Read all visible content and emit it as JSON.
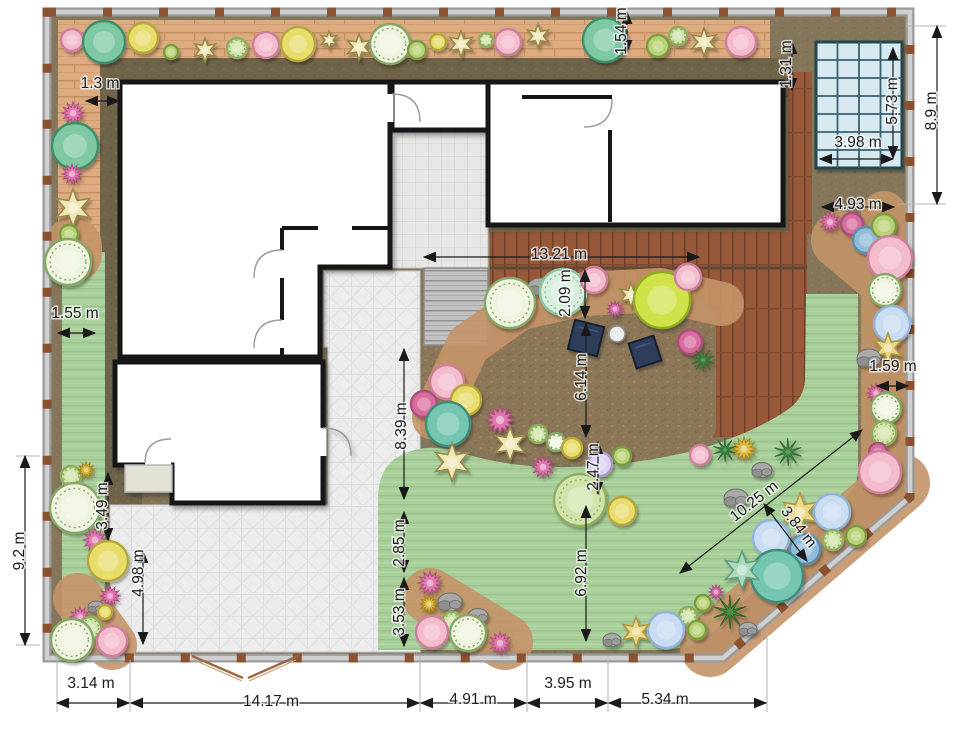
{
  "title": "garden-landscape-plan",
  "unit": "m",
  "dimensions": [
    {
      "label": "1.3 m",
      "x": 100,
      "y": 88,
      "rot": 0,
      "line": [
        86,
        101,
        119,
        101
      ]
    },
    {
      "label": "1.54 m",
      "x": 626,
      "y": 31,
      "rot": -90,
      "line": [
        627,
        12,
        627,
        52
      ]
    },
    {
      "label": "1.31 m",
      "x": 791,
      "y": 64,
      "rot": -90,
      "line": [
        792,
        42,
        792,
        90
      ]
    },
    {
      "label": "5.73 m",
      "x": 897,
      "y": 101,
      "rot": -90,
      "line": [
        893,
        48,
        893,
        158
      ]
    },
    {
      "label": "3.98 m",
      "x": 858,
      "y": 147,
      "rot": 0,
      "line": [
        820,
        159,
        893,
        159
      ]
    },
    {
      "label": "8.9 m",
      "x": 936,
      "y": 111,
      "rot": -90,
      "line": [
        937,
        26,
        937,
        204
      ]
    },
    {
      "label": "4.93 m",
      "x": 858,
      "y": 209,
      "rot": 0,
      "line": [
        822,
        207,
        894,
        207
      ]
    },
    {
      "label": "13.21 m",
      "x": 559,
      "y": 259,
      "rot": 0,
      "line": [
        424,
        257,
        699,
        257
      ]
    },
    {
      "label": "2.09 m",
      "x": 570,
      "y": 293,
      "rot": -90,
      "line": [
        585,
        270,
        585,
        318
      ]
    },
    {
      "label": "6.14 m",
      "x": 586,
      "y": 377,
      "rot": -90,
      "line": [
        586,
        324,
        586,
        437
      ]
    },
    {
      "label": "1.55 m",
      "x": 75,
      "y": 318,
      "rot": 0,
      "line": [
        58,
        333,
        95,
        333
      ]
    },
    {
      "label": "1.59 m",
      "x": 893,
      "y": 371,
      "rot": 0,
      "line": [
        877,
        386,
        908,
        386
      ]
    },
    {
      "label": "8.39 m",
      "x": 406,
      "y": 426,
      "rot": -90,
      "line": [
        404,
        349,
        404,
        499
      ]
    },
    {
      "label": "2.47 m",
      "x": 598,
      "y": 467,
      "rot": -90,
      "line": [
        598,
        442,
        598,
        494
      ]
    },
    {
      "label": "6.92 m",
      "x": 586,
      "y": 573,
      "rot": -90,
      "line": [
        586,
        506,
        586,
        641
      ]
    },
    {
      "label": "10.25 m",
      "x": 757,
      "y": 505,
      "rot": -38,
      "line": [
        680,
        573,
        862,
        430
      ]
    },
    {
      "label": "3.84 m",
      "x": 795,
      "y": 530,
      "rot": 52,
      "line": [
        764,
        504,
        807,
        561
      ]
    },
    {
      "label": "3.49 m",
      "x": 107,
      "y": 506,
      "rot": -90,
      "line": [
        108,
        473,
        108,
        540
      ]
    },
    {
      "label": "4.98 m",
      "x": 143,
      "y": 573,
      "rot": -90,
      "line": [
        143,
        551,
        143,
        644
      ]
    },
    {
      "label": "9.2 m",
      "x": 24,
      "y": 551,
      "rot": -90,
      "line": [
        25,
        456,
        25,
        645
      ]
    },
    {
      "label": "2.85 m",
      "x": 404,
      "y": 543,
      "rot": -90,
      "line": [
        404,
        512,
        404,
        572
      ]
    },
    {
      "label": "3.53 m",
      "x": 404,
      "y": 612,
      "rot": -90,
      "line": [
        404,
        578,
        404,
        646
      ]
    },
    {
      "label": "3.14 m",
      "x": 91,
      "y": 688,
      "rot": 0,
      "line": [
        57,
        703,
        129,
        703
      ]
    },
    {
      "label": "14.17 m",
      "x": 271,
      "y": 706,
      "rot": 0,
      "line": [
        131,
        703,
        419,
        703
      ]
    },
    {
      "label": "4.91 m",
      "x": 473,
      "y": 704,
      "rot": 0,
      "line": [
        421,
        703,
        526,
        703
      ]
    },
    {
      "label": "3.95 m",
      "x": 568,
      "y": 688,
      "rot": 0,
      "line": [
        528,
        703,
        607,
        703
      ]
    },
    {
      "label": "5.34 m",
      "x": 665,
      "y": 704,
      "rot": 0,
      "line": [
        609,
        703,
        766,
        703
      ]
    }
  ],
  "pool": {
    "x": 816,
    "y": 42,
    "w": 86,
    "h": 126,
    "cols": 4,
    "rows": 7,
    "fill": "#d7e8ee",
    "grid": "#3a616f",
    "border": "#24454f"
  },
  "furniture": {
    "loungers": [
      {
        "x": 586,
        "y": 338,
        "s": 30,
        "rot": 14
      },
      {
        "x": 645,
        "y": 352,
        "s": 26,
        "rot": -18
      }
    ],
    "lounger_fill": "#2d3c5a",
    "lounger_edge": "#17202e",
    "table": {
      "x": 617,
      "y": 334,
      "r": 8,
      "fill": "#ececec",
      "edge": "#8f8f8f"
    }
  },
  "palette": {
    "pink": {
      "f": "#f3bccd",
      "e": "#cd7f9c",
      "t": "c"
    },
    "magenta": {
      "f": "#e077ae",
      "e": "#b34d86",
      "t": "a"
    },
    "magenta2": {
      "f": "#d76d9f",
      "e": "#a94f7c",
      "t": "c"
    },
    "gold": {
      "f": "#e8dc6b",
      "e": "#b5a73e",
      "t": "c"
    },
    "goldspiky": {
      "f": "#d9b83a",
      "e": "#a8861f",
      "t": "a"
    },
    "star": {
      "f": "#efe7b8",
      "e": "#97894a",
      "t": "s"
    },
    "starGold": {
      "f": "#ead98a",
      "e": "#b09a40",
      "t": "s"
    },
    "starTeal": {
      "f": "#abd9bd",
      "e": "#5fa183",
      "t": "s"
    },
    "teal": {
      "f": "#7fc8a4",
      "e": "#418f6a",
      "t": "c"
    },
    "teal2": {
      "f": "#74c6b0",
      "e": "#3d8f7c",
      "t": "c"
    },
    "mint": {
      "f": "#d9efdd",
      "e": "#8cc4a0",
      "t": "c"
    },
    "dotted": {
      "f": "#eef4e0",
      "e": "#85a765",
      "t": "c"
    },
    "sage": {
      "f": "#b8d276",
      "e": "#7d9c42",
      "t": "c"
    },
    "sage2": {
      "f": "#cfe3ab",
      "e": "#8fae5e",
      "t": "c"
    },
    "lime": {
      "f": "#cfe24a",
      "e": "#8fae20",
      "t": "c"
    },
    "blue": {
      "f": "#c9dcf2",
      "e": "#93b3d9",
      "t": "c"
    },
    "blue2": {
      "f": "#8fbcd8",
      "e": "#5c8fae",
      "t": "c"
    },
    "lilac": {
      "f": "#ddd2f0",
      "e": "#a899cc",
      "t": "c"
    },
    "palm": {
      "f": "#58a358",
      "e": "#2f6f32",
      "t": "g"
    },
    "grass": {
      "f": "#4e8f46",
      "e": "#2e6327",
      "t": "g"
    },
    "rock": {
      "f": "#a9a9a9",
      "e": "#787878",
      "t": "r"
    }
  },
  "plants": [
    [
      72,
      40,
      11,
      "pink"
    ],
    [
      104,
      42,
      21,
      "teal"
    ],
    [
      143,
      38,
      15,
      "gold"
    ],
    [
      171,
      52,
      7,
      "sage"
    ],
    [
      205,
      50,
      12,
      "star"
    ],
    [
      237,
      48,
      10,
      "sage2"
    ],
    [
      266,
      45,
      13,
      "pink"
    ],
    [
      298,
      44,
      17,
      "gold"
    ],
    [
      329,
      40,
      9,
      "star"
    ],
    [
      359,
      47,
      13,
      "star"
    ],
    [
      390,
      44,
      20,
      "dotted"
    ],
    [
      417,
      50,
      9,
      "sage"
    ],
    [
      438,
      42,
      8,
      "gold"
    ],
    [
      461,
      44,
      13,
      "star"
    ],
    [
      486,
      40,
      7,
      "sage2"
    ],
    [
      508,
      42,
      13,
      "pink"
    ],
    [
      538,
      36,
      12,
      "star"
    ],
    [
      605,
      40,
      22,
      "teal"
    ],
    [
      658,
      46,
      11,
      "sage"
    ],
    [
      678,
      36,
      9,
      "sage2"
    ],
    [
      704,
      42,
      14,
      "star"
    ],
    [
      741,
      42,
      15,
      "pink"
    ],
    [
      73,
      113,
      11,
      "magenta"
    ],
    [
      75,
      146,
      23,
      "teal"
    ],
    [
      72,
      174,
      10,
      "magenta"
    ],
    [
      73,
      208,
      19,
      "star"
    ],
    [
      69,
      234,
      9,
      "sage"
    ],
    [
      68,
      262,
      23,
      "dotted"
    ],
    [
      71,
      476,
      10,
      "sage2"
    ],
    [
      86,
      470,
      8,
      "goldspiky"
    ],
    [
      75,
      508,
      25,
      "dotted"
    ],
    [
      95,
      540,
      12,
      "magenta"
    ],
    [
      108,
      561,
      20,
      "gold"
    ],
    [
      110,
      596,
      10,
      "magenta"
    ],
    [
      96,
      607,
      8,
      "rock"
    ],
    [
      80,
      617,
      10,
      "magenta"
    ],
    [
      90,
      628,
      11,
      "sage2"
    ],
    [
      105,
      612,
      7,
      "gold"
    ],
    [
      72,
      640,
      21,
      "dotted"
    ],
    [
      112,
      641,
      15,
      "pink"
    ],
    [
      447,
      382,
      17,
      "pink"
    ],
    [
      424,
      404,
      13,
      "magenta2"
    ],
    [
      466,
      400,
      15,
      "gold"
    ],
    [
      448,
      424,
      22,
      "teal2"
    ],
    [
      500,
      420,
      14,
      "magenta"
    ],
    [
      452,
      462,
      19,
      "star"
    ],
    [
      510,
      444,
      17,
      "star"
    ],
    [
      538,
      434,
      9,
      "sage2"
    ],
    [
      556,
      442,
      9,
      "dotted"
    ],
    [
      572,
      448,
      10,
      "gold"
    ],
    [
      543,
      467,
      11,
      "magenta"
    ],
    [
      600,
      464,
      12,
      "lilac"
    ],
    [
      622,
      456,
      9,
      "sage"
    ],
    [
      580,
      500,
      26,
      "sage2"
    ],
    [
      622,
      511,
      14,
      "gold"
    ],
    [
      540,
      287,
      12,
      "rock"
    ],
    [
      510,
      303,
      25,
      "dotted"
    ],
    [
      563,
      292,
      23,
      "mint"
    ],
    [
      594,
      280,
      13,
      "pink"
    ],
    [
      615,
      309,
      8,
      "magenta"
    ],
    [
      631,
      295,
      12,
      "star"
    ],
    [
      662,
      300,
      28,
      "lime"
    ],
    [
      688,
      277,
      13,
      "pink"
    ],
    [
      690,
      342,
      12,
      "magenta2"
    ],
    [
      703,
      360,
      12,
      "palm"
    ],
    [
      830,
      222,
      10,
      "magenta"
    ],
    [
      852,
      224,
      11,
      "magenta2"
    ],
    [
      866,
      240,
      13,
      "blue2"
    ],
    [
      884,
      226,
      12,
      "sage"
    ],
    [
      890,
      258,
      22,
      "pink"
    ],
    [
      885,
      290,
      16,
      "dotted"
    ],
    [
      892,
      324,
      18,
      "blue"
    ],
    [
      888,
      348,
      15,
      "starGold"
    ],
    [
      869,
      358,
      12,
      "rock"
    ],
    [
      876,
      393,
      9,
      "magenta"
    ],
    [
      886,
      408,
      15,
      "dotted"
    ],
    [
      884,
      433,
      12,
      "sage2"
    ],
    [
      878,
      452,
      9,
      "magenta2"
    ],
    [
      880,
      472,
      21,
      "pink"
    ],
    [
      700,
      455,
      10,
      "pink"
    ],
    [
      725,
      450,
      12,
      "palm"
    ],
    [
      744,
      449,
      12,
      "goldspiky"
    ],
    [
      762,
      470,
      10,
      "rock"
    ],
    [
      788,
      452,
      14,
      "palm"
    ],
    [
      736,
      498,
      12,
      "rock"
    ],
    [
      800,
      512,
      19,
      "starGold"
    ],
    [
      832,
      512,
      18,
      "blue"
    ],
    [
      856,
      536,
      10,
      "sage"
    ],
    [
      833,
      540,
      10,
      "sage2"
    ],
    [
      805,
      549,
      15,
      "blue2"
    ],
    [
      771,
      538,
      18,
      "blue"
    ],
    [
      777,
      576,
      26,
      "teal2"
    ],
    [
      742,
      570,
      19,
      "starTeal"
    ],
    [
      716,
      592,
      7,
      "magenta"
    ],
    [
      730,
      612,
      17,
      "grass"
    ],
    [
      703,
      603,
      8,
      "sage"
    ],
    [
      688,
      616,
      9,
      "sage2"
    ],
    [
      748,
      629,
      9,
      "rock"
    ],
    [
      666,
      630,
      18,
      "blue"
    ],
    [
      636,
      632,
      15,
      "starGold"
    ],
    [
      612,
      640,
      9,
      "rock"
    ],
    [
      697,
      630,
      9,
      "sage"
    ],
    [
      430,
      583,
      12,
      "magenta"
    ],
    [
      429,
      604,
      9,
      "goldspiky"
    ],
    [
      450,
      602,
      12,
      "rock"
    ],
    [
      452,
      622,
      10,
      "sage2"
    ],
    [
      478,
      616,
      10,
      "rock"
    ],
    [
      432,
      632,
      16,
      "pink"
    ],
    [
      468,
      633,
      18,
      "dotted"
    ],
    [
      500,
      643,
      11,
      "magenta"
    ]
  ],
  "beds": [
    {
      "pts": [
        [
          434,
          418
        ],
        [
          468,
          345
        ],
        [
          520,
          308
        ],
        [
          585,
          294
        ],
        [
          660,
          290
        ],
        [
          722,
          304
        ]
      ],
      "w": 44
    },
    {
      "pts": [
        [
          884,
          214
        ],
        [
          884,
          478
        ]
      ],
      "w": 46
    },
    {
      "pts": [
        [
          710,
          647
        ],
        [
          900,
          483
        ]
      ],
      "w": 60
    },
    {
      "pts": [
        [
          430,
          596
        ],
        [
          505,
          642
        ]
      ],
      "w": 56
    },
    {
      "pts": [
        [
          78,
          598
        ],
        [
          112,
          645
        ]
      ],
      "w": 50
    },
    {
      "pts": [
        [
          73,
          246
        ],
        [
          73,
          254
        ]
      ],
      "w": 58
    },
    {
      "pts": [
        [
          840,
          240
        ],
        [
          878,
          272
        ]
      ],
      "w": 58
    }
  ],
  "bed_color": "#c49468",
  "colors": {
    "lawn": "#a8cf9a",
    "tile": "#ececec",
    "plank_tan": "#dcab80",
    "deck_red": "#98593b",
    "gravel": "#8b7758",
    "base_olive": "#83765a",
    "band_olive": "#6f6349",
    "fence_post": "#8a5230"
  }
}
